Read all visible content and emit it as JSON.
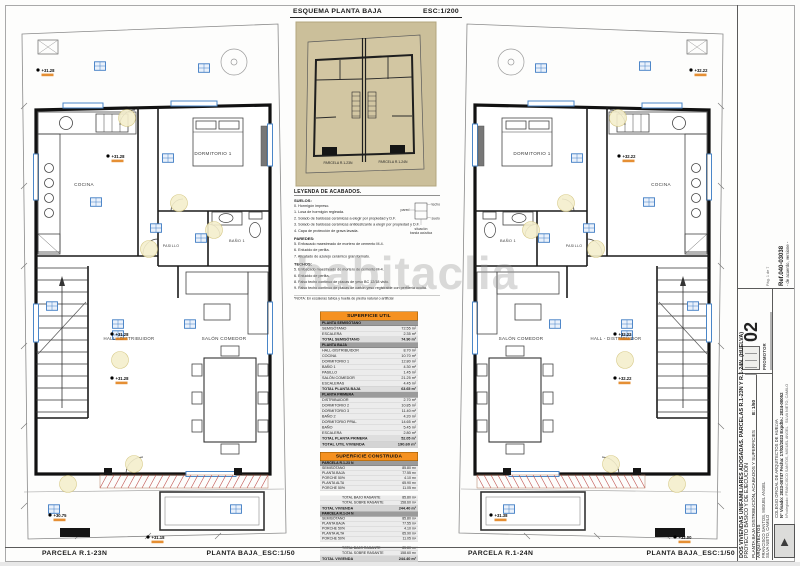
{
  "watermark": "habitaclia",
  "esquema": {
    "title": "ESQUEMA PLANTA BAJA",
    "scale": "ESC:1/200",
    "labels": [
      "PARCELA R.1-23N",
      "PARCELA R.1-24N"
    ]
  },
  "footer": {
    "left_parcel": "PARCELA R.1-23N",
    "left_scale": "PLANTA BAJA_ESC:1/50",
    "right_parcel": "PARCELA R.1-24N",
    "right_scale": "PLANTA BAJA_ESC:1/50"
  },
  "legend": {
    "title": "LEYENDA DE ACABADOS.",
    "sections": [
      {
        "heading": "SUELOS:",
        "items": [
          "0. Hormigón impreso.",
          "1. Losa de hormigón regleada.",
          "2. Solado de baldosas cerámicas a elegir por propiedad y D.F.",
          "3. Solado de baldosas cerámicas antideslizante a elegir por propiedad y D.F.",
          "4. Capa de protección de grava lavada."
        ]
      },
      {
        "heading": "PAREDES:",
        "items": [
          "5. Enfoscado maestreado de mortero de cemento M-4.",
          "6. Enlucido de perlita.",
          "7. Alicatado de azulejo cerámico gran formato."
        ]
      },
      {
        "heading": "TECHOS:",
        "items": [
          "5. Enfoscado maestreado de mortero de cemento M-4.",
          "6. Enlucido de perlita.",
          "8. Falso techo continuo de placas de yeso BC 12/18 visto.",
          "9. Falso techo continuo de placas de cartón yeso registrable con perfilería oculta."
        ]
      }
    ],
    "note": "*NOTA: En escaleras tabica y huella de piedra natural o artificial",
    "diagram": {
      "top": "techo",
      "bottom": "suelo",
      "left": "pared",
      "caption": "situación banda acústica"
    }
  },
  "superficie_util": {
    "title": "SUPERFICIE UTIL",
    "groups": [
      {
        "bar": "PLANTA SEMISÓTANO",
        "rows": [
          [
            "SEMISÓTANO",
            "72.55 m²"
          ],
          [
            "ESCALERA",
            "2.35 m²"
          ]
        ],
        "total": [
          "TOTAL SEMISÓTANO",
          "74.90 m²"
        ]
      },
      {
        "bar": "PLANTA BAJA",
        "rows": [
          [
            "HALL-DISTRIBUIDOR",
            "8.70 m²"
          ],
          [
            "COCINA",
            "10.70 m²"
          ],
          [
            "DORMITORIO 1",
            "12.80 m²"
          ],
          [
            "BAÑO 1",
            "4.30 m²"
          ],
          [
            "PASILLO",
            "1.45 m²"
          ],
          [
            "SALÓN COMEDOR",
            "21.25 m²"
          ],
          [
            "ESCALERAS",
            "4.45 m²"
          ]
        ],
        "total": [
          "TOTAL PLANTA BAJA",
          "63.65 m²"
        ]
      },
      {
        "bar": "PLANTA PRIMERA",
        "rows": [
          [
            "DISTRIBUIDOR",
            "2.70 m²"
          ],
          [
            "DORMITORIO 2",
            "10.85 m²"
          ],
          [
            "DORMITORIO 3",
            "11.40 m²"
          ],
          [
            "BAÑO 2",
            "4.20 m²"
          ],
          [
            "DORMITORIO PPAL.",
            "14.65 m²"
          ],
          [
            "BAÑO",
            "5.45 m²"
          ],
          [
            "ESCALERA",
            "2.80 m²"
          ]
        ],
        "total": [
          "TOTAL PLANTA PRIMERA",
          "52.05 m²"
        ]
      }
    ],
    "grand_total": [
      "TOTAL UTIL VIVIENDA",
      "190.60 m²"
    ]
  },
  "superficie_construida": {
    "title": "SUPERFICIE CONSTRUIDA",
    "blocks": [
      {
        "bar": "PARCELA R.1-23 N",
        "rows": [
          [
            "SEMISÓTANO",
            "85.80 m²"
          ],
          [
            "PLANTA BAJA",
            "77.55 m²"
          ],
          [
            "PORCHE 50%",
            "4.10 m²"
          ],
          [
            "PLANTA ALTA",
            "65.90 m²"
          ],
          [
            "PORCHE 50%",
            "11.05 m²"
          ]
        ],
        "totals": [
          [
            "TOTAL BAJO RASANTE",
            "85.80 m²"
          ],
          [
            "TOTAL SOBRE RASANTE",
            "158.60 m²"
          ],
          [
            "TOTAL VIVIENDA",
            "244.40 m²"
          ]
        ]
      },
      {
        "bar": "PARCELA R.1-24 N",
        "rows": [
          [
            "SEMISÓTANO",
            "85.80 m²"
          ],
          [
            "PLANTA BAJA",
            "77.55 m²"
          ],
          [
            "PORCHE 50%",
            "4.10 m²"
          ],
          [
            "PLANTA ALTA",
            "65.90 m²"
          ],
          [
            "PORCHE 50%",
            "11.05 m²"
          ]
        ],
        "totals": [
          [
            "TOTAL BAJO RASANTE",
            "85.80 m²"
          ],
          [
            "TOTAL SOBRE RASANTE",
            "158.60 m²"
          ],
          [
            "TOTAL VIVIENDA",
            "244.40 m²"
          ]
        ]
      }
    ]
  },
  "plans": {
    "left": {
      "rooms": [
        {
          "label": "DORMITORIO 1",
          "x": 205,
          "y": 149,
          "s": 4.6
        },
        {
          "label": "COCINA",
          "x": 76,
          "y": 180,
          "s": 4.6
        },
        {
          "label": "BAÑO 1",
          "x": 229,
          "y": 236,
          "s": 3.9
        },
        {
          "label": "PASILLO",
          "x": 163,
          "y": 241,
          "s": 3.5
        },
        {
          "label": "HALL - DISTRIBUIDOR",
          "x": 121,
          "y": 334,
          "s": 4.3
        },
        {
          "label": "SALÓN COMEDOR",
          "x": 216,
          "y": 334,
          "s": 4.6
        }
      ],
      "levels": [
        {
          "t": "+31.28",
          "x": 30,
          "y": 64
        },
        {
          "t": "+31.28",
          "x": 100,
          "y": 150
        },
        {
          "t": "+31.28",
          "x": 104,
          "y": 328
        },
        {
          "t": "+31.28",
          "x": 104,
          "y": 372
        },
        {
          "t": "+31.18",
          "x": 140,
          "y": 531
        },
        {
          "t": "+30.75",
          "x": 42,
          "y": 509
        }
      ]
    },
    "right": {
      "rooms": [
        {
          "label": "DORMITORIO 1",
          "x": 85,
          "y": 149,
          "s": 4.6
        },
        {
          "label": "COCINA",
          "x": 214,
          "y": 180,
          "s": 4.6
        },
        {
          "label": "BAÑO 1",
          "x": 61,
          "y": 236,
          "s": 3.9
        },
        {
          "label": "PASILLO",
          "x": 127,
          "y": 241,
          "s": 3.5
        },
        {
          "label": "HALL - DISTRIBUIDOR",
          "x": 169,
          "y": 334,
          "s": 4.3
        },
        {
          "label": "SALÓN COMEDOR",
          "x": 74,
          "y": 334,
          "s": 4.6
        }
      ],
      "levels": [
        {
          "t": "+32.22",
          "x": 244,
          "y": 64
        },
        {
          "t": "+32.22",
          "x": 172,
          "y": 150
        },
        {
          "t": "+32.22",
          "x": 168,
          "y": 328
        },
        {
          "t": "+32.22",
          "x": 168,
          "y": 372
        },
        {
          "t": "+32.00",
          "x": 228,
          "y": 531
        },
        {
          "t": "+31.38",
          "x": 44,
          "y": 509
        }
      ]
    }
  },
  "titleblock": {
    "sheet_number": "02",
    "project_name": "DOS VIVIENDAS UNIFAMILIARES ADOSADAS. PARCELAS R.1-23N Y R.1-24N. (HUELVA)",
    "project_type": "PROYECTO BÁSICO Y DE EJECUCIÓN",
    "sheet_title": "PLANTA BAJA DISTRIBUCIÓN, ACABADOS Y SUPERFICIES",
    "scale": "E: 1/50",
    "promotor_label": "PROMOTOR",
    "architects_label": "ARQUITECTOS",
    "architects": [
      "FRANCISCO SANTOS, MIGUEL ANGEL",
      "SILVA NIETO, CAMILO"
    ],
    "colegio": "COLEGIO OFICIAL DE ARQUITECTOS DE HUELVA",
    "visado_line": "Nº Visado: 2023-00747    Fecha: 17/02/2023    Expdte.: 2024-00052",
    "colegiados": "Nºcolegiado: FRANCISCO SANTOS, MIGUEL ANGEL · SILVA NIETO, CAMILO",
    "ref": "Ref.040-03038",
    "ref_note": "- de acuerdo, versione -",
    "page": "Pág. 1 de 7"
  }
}
